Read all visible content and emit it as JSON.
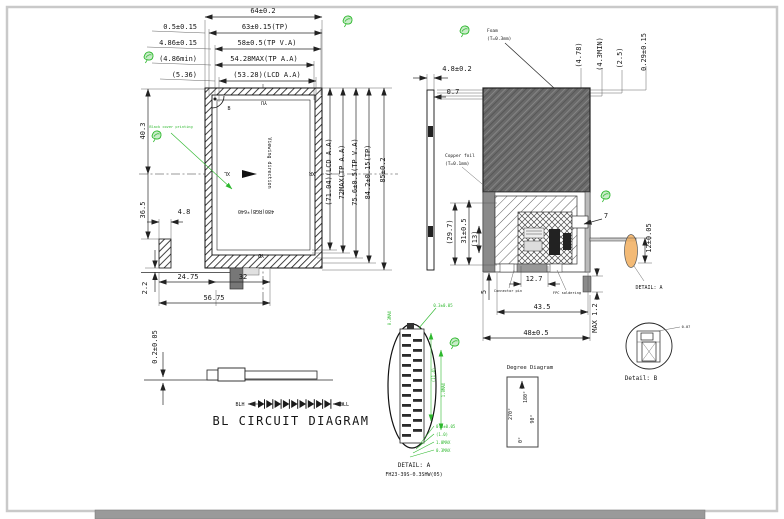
{
  "front_view": {
    "dims": {
      "d64": "64±0.2",
      "d05": "0.5±0.15",
      "d63": "63±0.15(TP)",
      "d486": "4.86±0.15",
      "d58": "58±0.5(TP V.A)",
      "d486min": "(4.86min)",
      "d5428": "54.28MAX(TP A.A)",
      "d536": "(5.36)",
      "d5328": "(53.28)(LCD A.A)",
      "d478": "(4.78)",
      "d43": "(4.3MIN)",
      "d25": "(2.5)",
      "d029": "0.29±0.15",
      "d403": "40.3",
      "d365": "36.5",
      "d48": "4.8",
      "d22": "2.2",
      "d2475": "24.75",
      "d32": "32",
      "d5675": "56.75",
      "d7104": "(71.04)(LCD A.A)",
      "d72": "72MAX(TP A.A)",
      "d756": "75.6±0.5(TP V.A)",
      "d842": "84.2±0.15(TP)",
      "d85": "85±0.2"
    },
    "labels": {
      "resolution": "480(RGB)*640",
      "viewing": "Viewing direction",
      "yu": "YU",
      "yd": "YD",
      "xl": "XL",
      "xr": "XR",
      "b": "B",
      "black_cover": "Black cover printing"
    }
  },
  "side_view": {
    "dims": {
      "d48": "4.8±0.2",
      "d07": "0.7"
    }
  },
  "rear_view": {
    "labels": {
      "foam": "Foam",
      "foam_t": "(T=0.3mm)",
      "copper": "Copper foil",
      "copper_t": "(T=0.1mm)",
      "detail_a": "DETAIL: A",
      "note1": "Connector pin",
      "note2": "FPC soldering"
    },
    "dims": {
      "d297": "(29.7)",
      "d31": "31±0.5",
      "d13": "(13)",
      "d127": "12.7",
      "d435": "43.5",
      "d48": "48±0.5",
      "d5": "5",
      "dmax": "MAX 1.2",
      "d7": "7",
      "d12": "12±0.05"
    }
  },
  "bl_circuit": {
    "dim": "0.2±0.05",
    "blh": "BLH",
    "bll": "BLL",
    "title": "BL CIRCUIT DIAGRAM",
    "led_count": 9
  },
  "detail_a": {
    "title": "DETAIL: A",
    "part_number": "FH23-39S-0.3SHW(05)",
    "pin_count": 21,
    "dims": [
      "0.3MAX",
      "0.3±0.05",
      "(11.4)",
      "1.0MAX",
      "0.3±0.05",
      "(1.0)",
      "1.0MAX",
      "0.3MAX"
    ]
  },
  "degree_diagram": {
    "title": "Degree Diagram",
    "top": "180°",
    "left": "270°",
    "right": "90°",
    "bottom": "0°"
  },
  "detail_b": {
    "title": "Detail: B",
    "dim": "0.07"
  }
}
